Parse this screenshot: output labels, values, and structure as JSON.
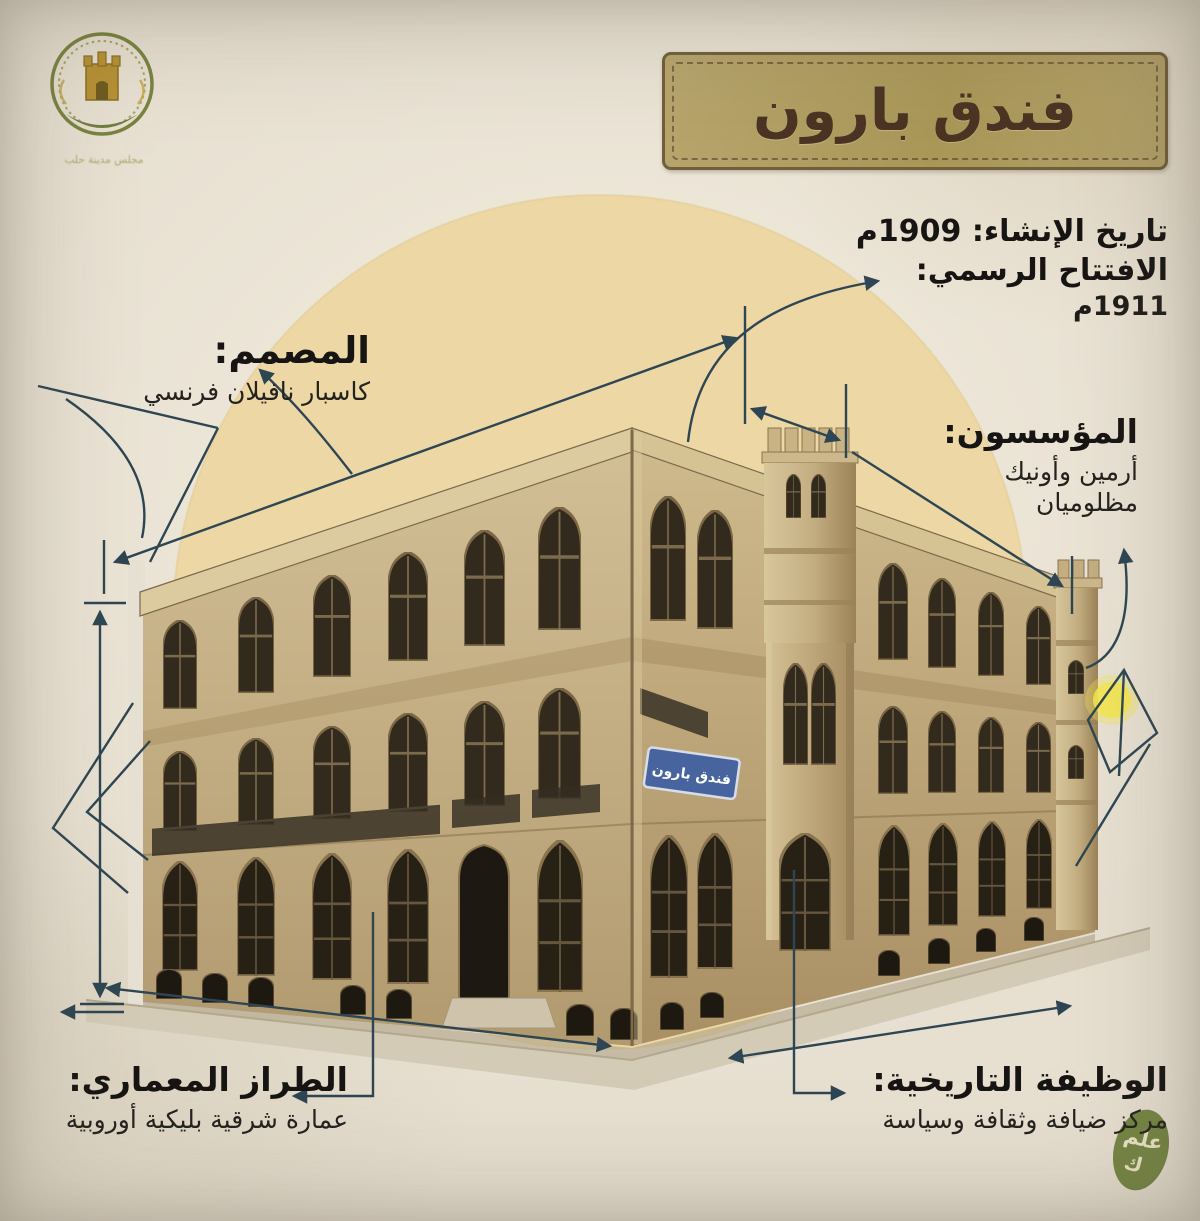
{
  "poster": {
    "title": "فندق بارون",
    "logo": {
      "caption": "مجلس مدينة حلب"
    },
    "building_sign": "فندق بارون",
    "watermark": {
      "line1": "علم",
      "line2": "ك"
    },
    "annotations": {
      "construction": {
        "label": "تاريخ الإنشاء: 1909م"
      },
      "opening": {
        "label": "الافتتاح الرسمي:",
        "value": "1911م"
      },
      "designer": {
        "title": "المصمم:",
        "text": "كاسبار نافيلان فرنسي"
      },
      "founders": {
        "title": "المؤسسون:",
        "line1": "أرمين وأونيك",
        "line2": "مظلوميان"
      },
      "style": {
        "title": "الطراز المعماري:",
        "text": "عمارة شرقية بليكية أوروبية"
      },
      "function": {
        "title": "الوظيفة التاريخية:",
        "text": "مركز ضيافة وثقافة وسياسة"
      }
    },
    "colors": {
      "paper": "#e7e0d1",
      "sand_circle": "#ecd7a5",
      "ink_blueprint": "#2e4653",
      "banner_fill": "#b3a169",
      "banner_text": "#4b3423",
      "stone": "#c3ae84",
      "sign_blue": "#47649f",
      "watermark_green": "#6d7f39",
      "heading_text": "#161513"
    }
  }
}
